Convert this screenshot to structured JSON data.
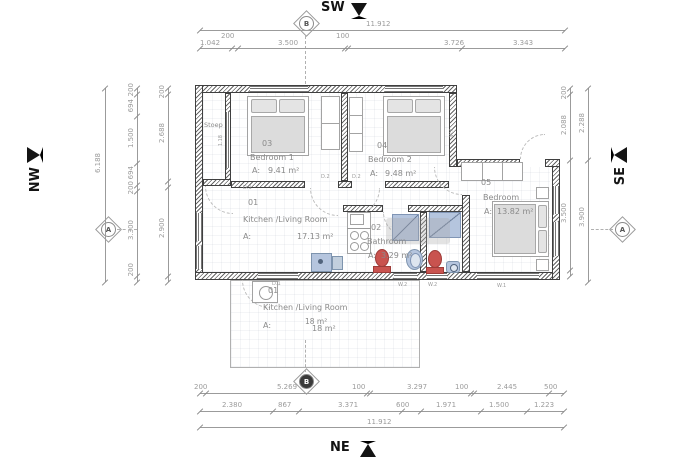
{
  "compass": {
    "sw": "SW",
    "nw": "NW",
    "se": "SE",
    "ne": "NE"
  },
  "markers": {
    "a": "A",
    "b": "B"
  },
  "dims": {
    "top": {
      "total": "11.912",
      "seg": [
        "1.042",
        "200",
        "3.500",
        "100",
        "3.726",
        "3.343"
      ]
    },
    "bottom": {
      "total": "11.912",
      "r1": [
        "200",
        "5.269",
        "100",
        "3.297",
        "100",
        "2.445",
        "500"
      ],
      "r2": [
        "2.380",
        "867",
        "3.371",
        "600",
        "1.971",
        "1.500",
        "1.223"
      ]
    },
    "left": {
      "total": "6.188",
      "mid": [
        "200",
        "694",
        "1.500",
        "694",
        "200",
        "3.300",
        "200"
      ],
      "inner": [
        "200",
        "2.688",
        "2.900"
      ]
    },
    "right": {
      "inner": [
        "200",
        "2.088",
        "3.500"
      ],
      "outer": [
        "2.288",
        "3.900"
      ]
    }
  },
  "rooms": {
    "stoep": {
      "name": "Stoep"
    },
    "bedroom1": {
      "number": "03",
      "name": "Bedroom 1",
      "area_prefix": "A:",
      "area": "9.41 m²"
    },
    "bedroom2": {
      "number": "04",
      "name": "Bedroom 2",
      "area_prefix": "A:",
      "area": "9.48 m²"
    },
    "bedroom3": {
      "number": "05",
      "name": "Bedroom",
      "area_prefix": "A:",
      "area": "13.82 m²"
    },
    "kitchen": {
      "number": "01",
      "name": "Kitchen /Living Room",
      "area_prefix": "A:",
      "area": "17.13 m²"
    },
    "bathroom": {
      "number": "02",
      "name": "Bathroom",
      "area_prefix": "A:",
      "area": "3.29 m²"
    },
    "terrace": {
      "number": "01",
      "name": "Kitchen /Living Room",
      "area_prefix": "A:",
      "area": "18 m²"
    }
  },
  "wall_labels": {
    "d1_stoep": "D.1",
    "d2_b1": "D.2",
    "d2_b2": "D.2",
    "d1_bottom": "D.1",
    "w2_a": "W.2",
    "w2_b": "W.2",
    "w1_bottom": "W.1",
    "w1_upper": "W.1",
    "win_stoep": "1.18"
  },
  "colors": {
    "wall": "#3f3f3f",
    "dim": "#9b9b9b",
    "fixture_red": "#c9534f",
    "fixture_blue": "#b5c5de",
    "bed_fill": "#dcdcdc"
  }
}
